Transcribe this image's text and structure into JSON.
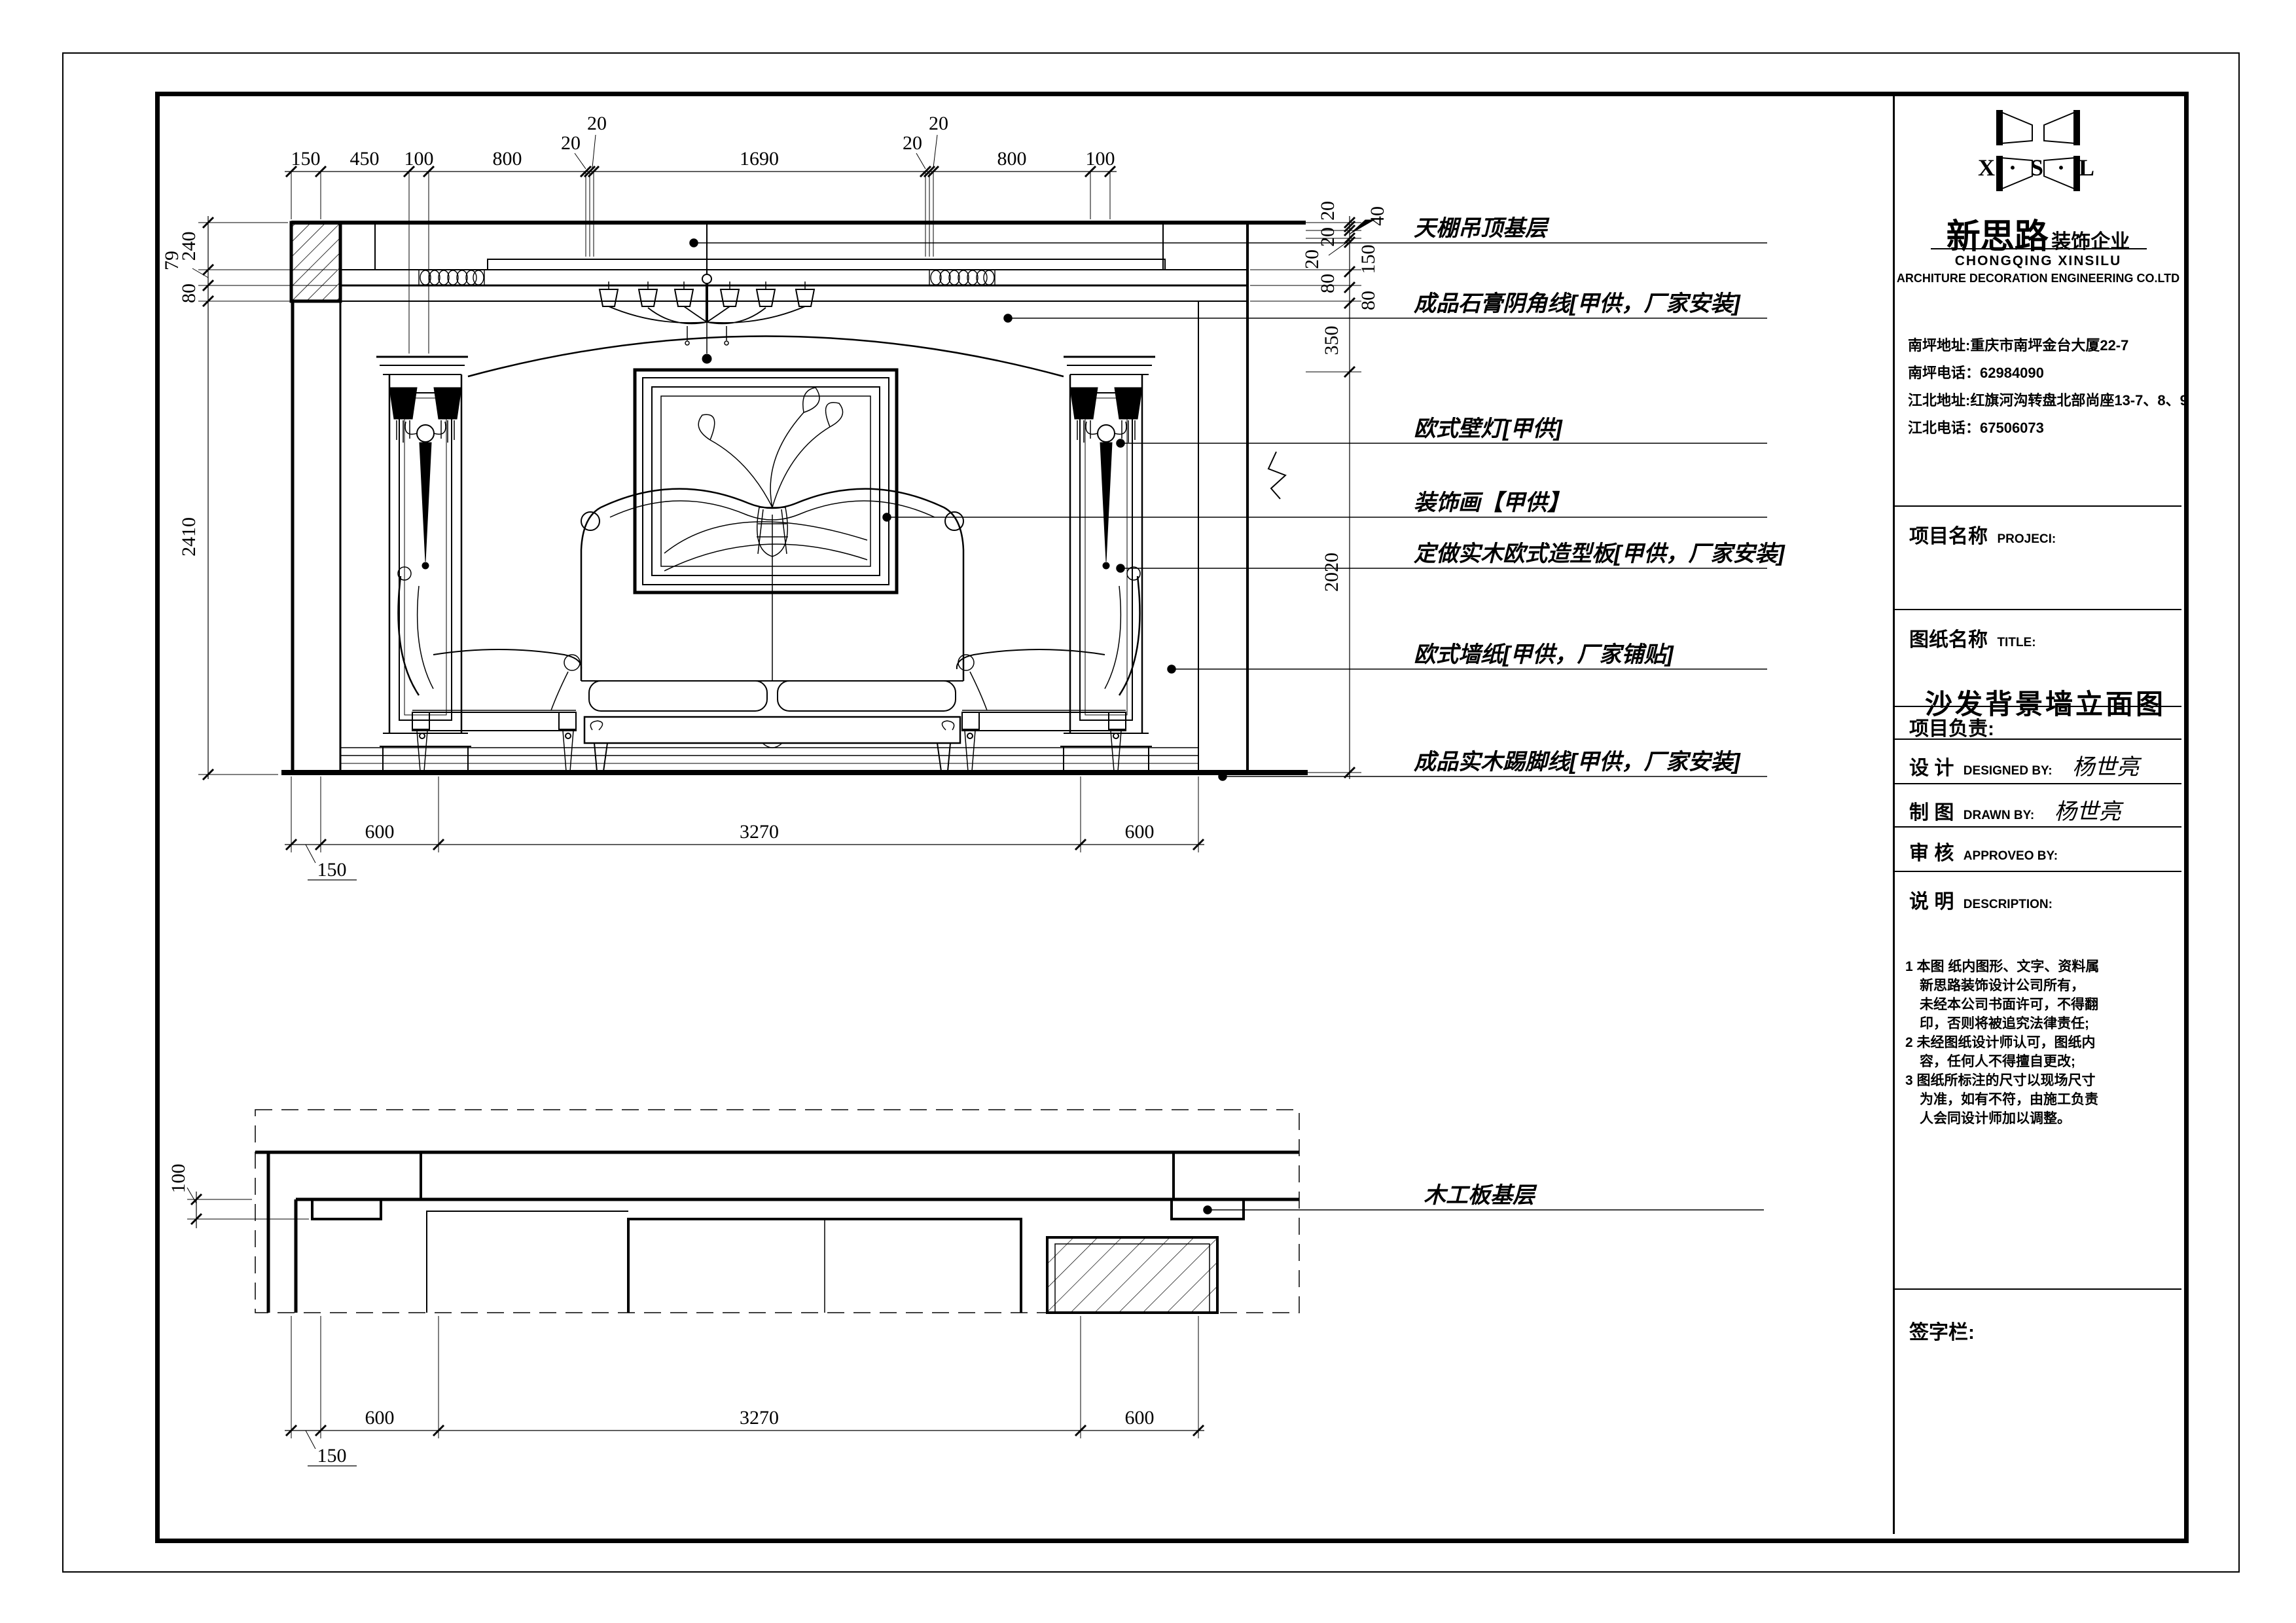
{
  "title_block": {
    "logo_letters": "X · S · L",
    "company_cn": "新思路",
    "company_suffix": "装饰企业",
    "company_en1": "CHONGQING XINSILU",
    "company_en2": "ARCHITURE DECORATION ENGINEERING CO.LTD",
    "addresses": [
      "南坪地址:重庆市南坪金台大厦22-7",
      "南坪电话：62984090",
      "江北地址:红旗河沟转盘北部尚座13-7、8、9",
      "江北电话：67506073"
    ],
    "project_label": "项目名称",
    "project_label_en": "PROJECI:",
    "drawing_label": "图纸名称",
    "drawing_label_en": "TITLE:",
    "drawing_title": "沙发背景墙立面图",
    "leader_label": "项目负责:",
    "design_label": "设  计",
    "design_en": "DESIGNED BY:",
    "designer": "杨世亮",
    "draft_label": "制  图",
    "draft_en": "DRAWN BY:",
    "drafter": "杨世亮",
    "approve_label": "审  核",
    "approve_en": "APPROVEO BY:",
    "desc_label": "说  明",
    "desc_en": "DESCRIPTION:",
    "notes": [
      "1 本图 纸内图形、文字、资料属",
      "新思路装饰设计公司所有，",
      "未经本公司书面许可，不得翻",
      "印，否则将被追究法律责任;",
      "2 未经图纸设计师认可，图纸内",
      "容，任何人不得擅自更改;",
      "3 图纸所标注的尺寸以现场尺寸",
      "为准，如有不符，由施工负责",
      "人会同设计师加以调整。"
    ],
    "signature_label": "签字栏:"
  },
  "callouts": [
    "天棚吊顶基层",
    "成品石膏阴角线[甲供，厂家安装]",
    "欧式壁灯[甲供]",
    "装饰画【甲供】",
    "定做实木欧式造型板[甲供，厂家安装]",
    "欧式墙纸[甲供，厂家铺贴]",
    "成品实木踢脚线[甲供，厂家安装]",
    "木工板基层"
  ],
  "dims": {
    "top": [
      "150",
      "450",
      "100",
      "800",
      "20",
      "20",
      "1690",
      "20",
      "20",
      "800",
      "100"
    ],
    "left": [
      "240",
      "79",
      "80",
      "2410"
    ],
    "right": [
      "20",
      "20",
      "40",
      "20",
      "150",
      "80",
      "80",
      "350",
      "2020"
    ],
    "bottom_upper": [
      "150",
      "600",
      "3270",
      "600"
    ],
    "bottom_lower": [
      "150",
      "600",
      "3270",
      "600"
    ],
    "lower_left": [
      "100"
    ]
  }
}
